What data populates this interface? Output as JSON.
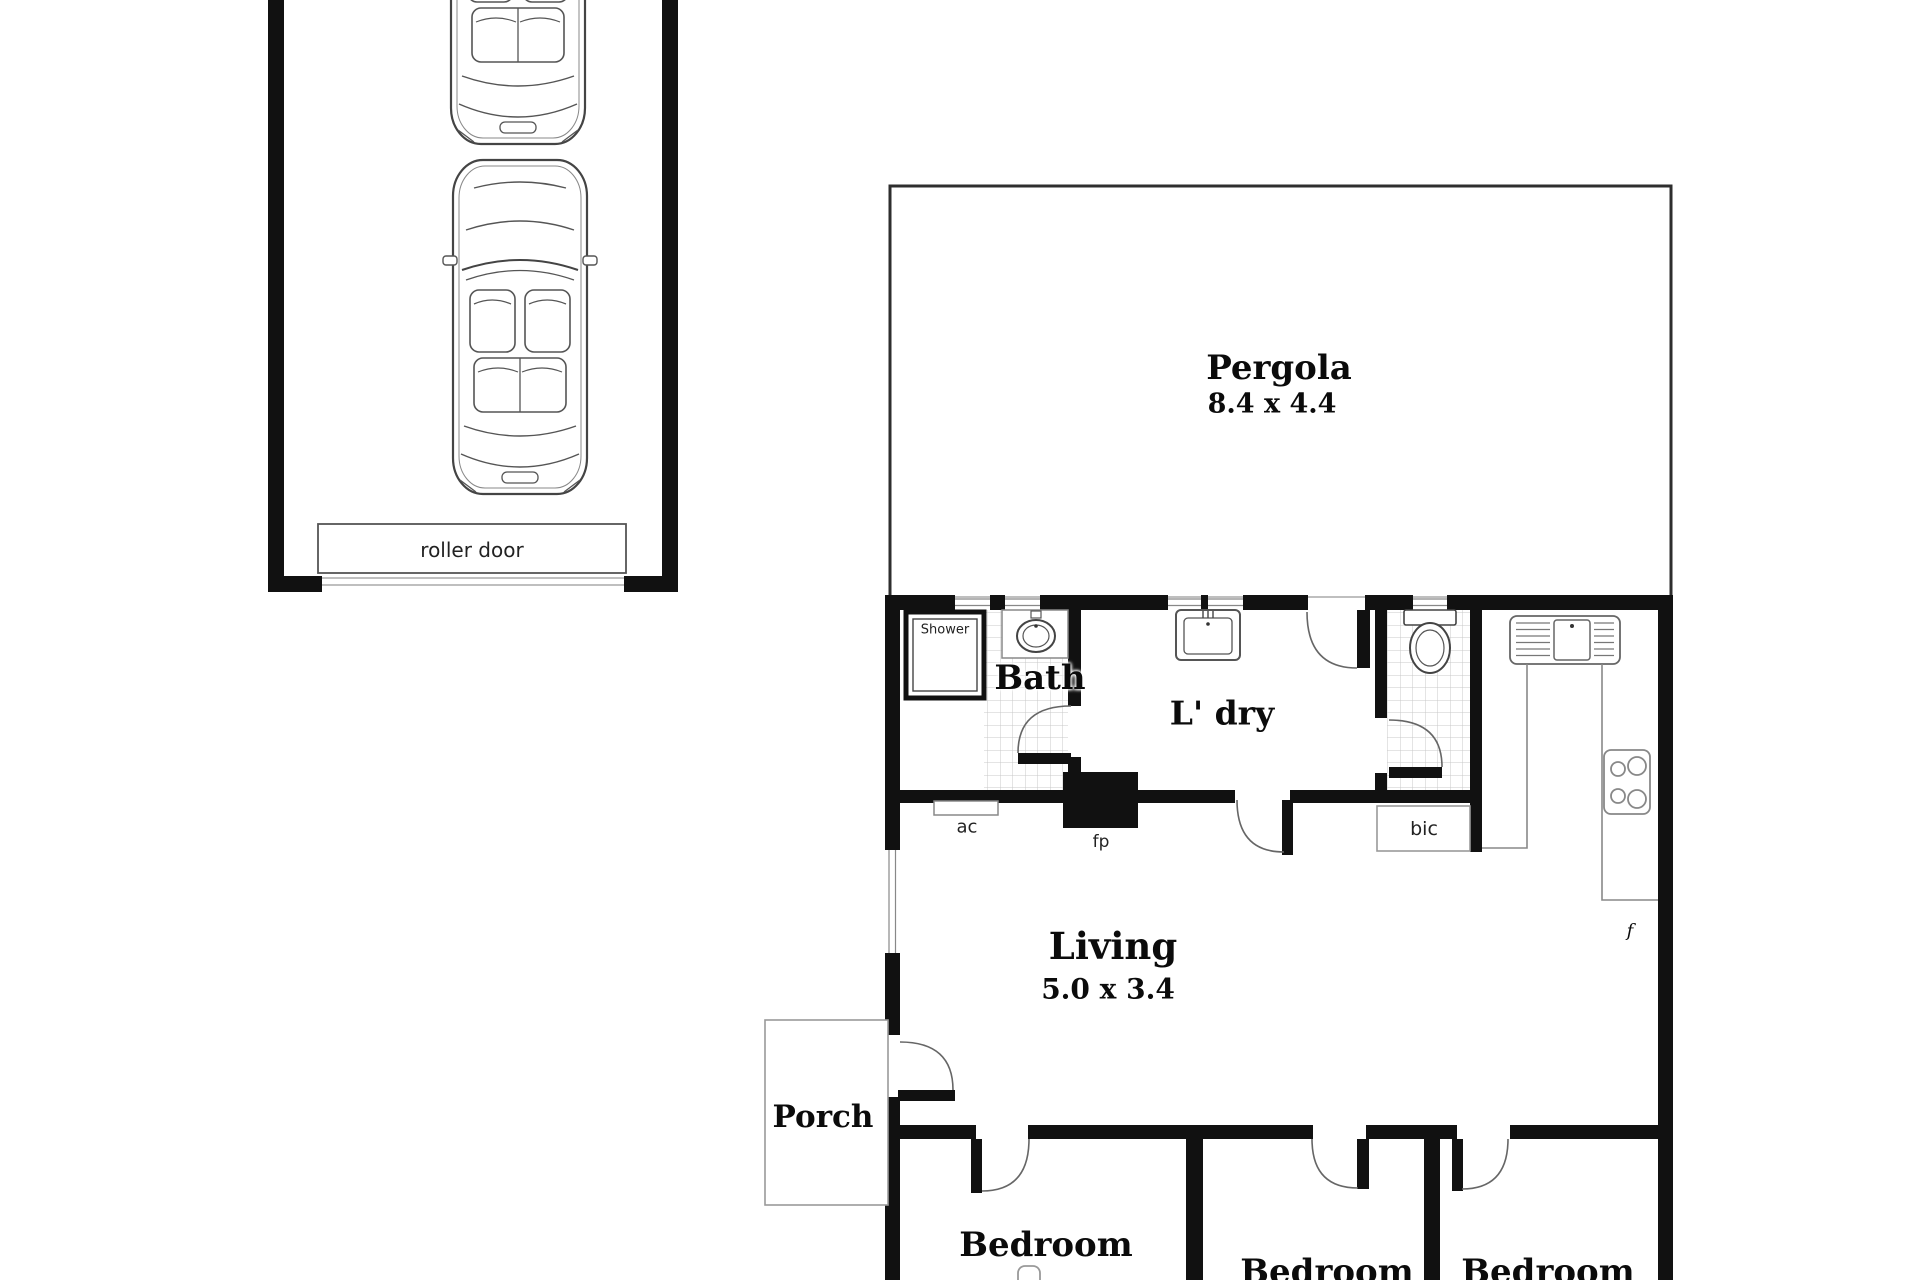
{
  "garage": {
    "roller_door_label": "roller door",
    "car_icons": [
      "convertible-car-top-view",
      "convertible-car-top-view"
    ]
  },
  "rooms": {
    "pergola": {
      "label": "Pergola",
      "dims": "8.4 x 4.4"
    },
    "bath": {
      "label": "Bath"
    },
    "laundry": {
      "label": "L' dry"
    },
    "living": {
      "label": "Living",
      "dims": "5.0 x 3.4"
    },
    "porch": {
      "label": "Porch"
    },
    "bedroom1": {
      "label": "Bedroom"
    },
    "bedroom2": {
      "label": "Bedroom"
    },
    "bedroom3": {
      "label": "Bedroom"
    }
  },
  "annotations": {
    "shower": "Shower",
    "air_conditioner": "ac",
    "fireplace": "fp",
    "built_in_cupboard": "bic",
    "fridge": "f"
  },
  "colors": {
    "wall": "#111111",
    "outline": "#555555",
    "thin_line": "#999999",
    "tile_grid": "#c9c9c9",
    "background": "#ffffff"
  }
}
